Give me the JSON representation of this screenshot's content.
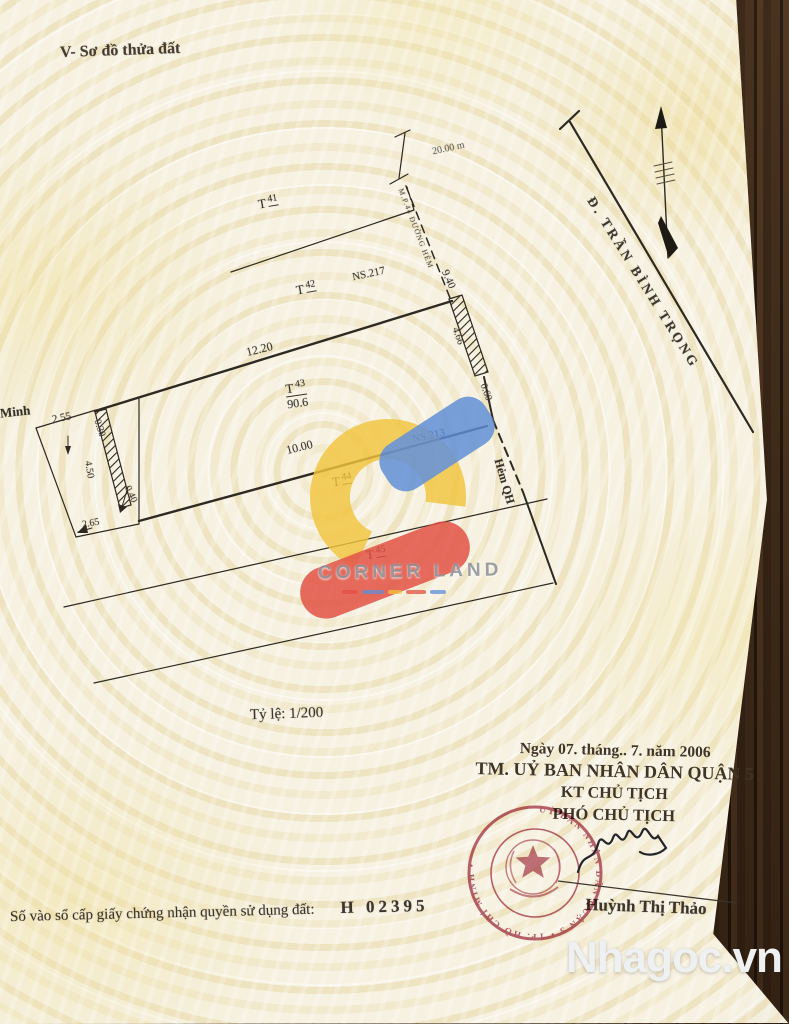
{
  "page": {
    "title": "V- Sơ đồ thửa đất",
    "scale_label": "Tỷ lệ: 1/200",
    "registry_label": "Số vào sổ cấp giấy chứng nhận quyền sử dụng đất:",
    "registry_number": "H 02395"
  },
  "diagram": {
    "street_name": "Đ. TRẦN BÌNH TRỌNG",
    "alley_label": "Hẻm QH",
    "edge_note": "M.P.44 ĐƯỜNG HẺM",
    "neighbor_label": "Minh",
    "map_refs": {
      "ref1": "NS.217",
      "ref2": "NS.213"
    },
    "parcels": [
      {
        "prefix": "T",
        "num": "41"
      },
      {
        "prefix": "T",
        "num": "42"
      },
      {
        "prefix": "T",
        "num": "43",
        "area": "90.6"
      },
      {
        "prefix": "T",
        "num": "44"
      },
      {
        "prefix": "T",
        "num": "45"
      }
    ],
    "measurements": {
      "street_width": "20.00 m",
      "front": "12.20",
      "depth": "10.00",
      "left_a": "2.55",
      "left_b": "0.30",
      "left_c": "4.50",
      "left_d": "0.40",
      "left_e": "2.65",
      "right_a": "9.40",
      "right_b": "4.66",
      "right_c": "0.60"
    }
  },
  "approval": {
    "date_line": "Ngày 07. tháng.. 7. năm 2006",
    "committee": "TM. UỶ BAN NHÂN DÂN QUẬN 5",
    "kt_line": "KT CHỦ TỊCH",
    "deputy_line": "PHÓ CHỦ TỊCH",
    "signer_name": "Huỳnh Thị Thảo",
    "stamp_text": "UỶ BAN NHÂN DÂN QUẬN 5 • TP. HỒ CHÍ MINH •"
  },
  "watermarks": {
    "corner_land": "CORNER LAND",
    "site": "Nhagoc.vn"
  }
}
